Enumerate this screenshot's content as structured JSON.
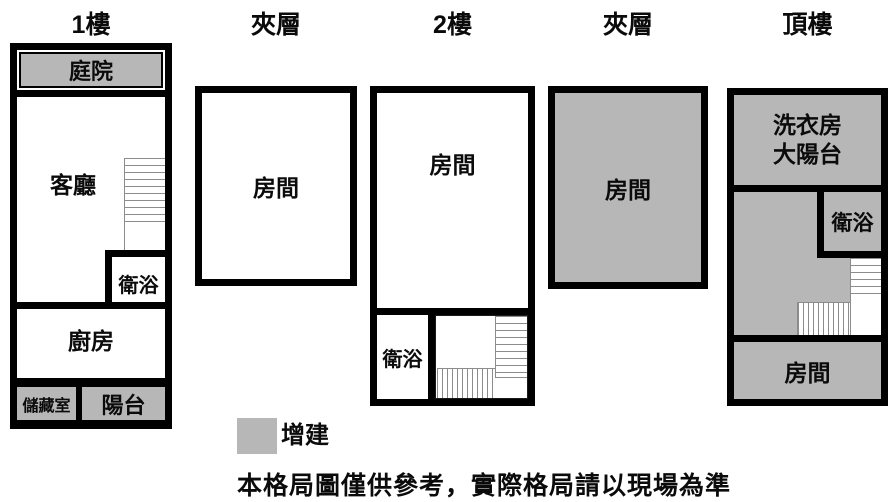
{
  "diagram": {
    "floors": [
      {
        "title": "1樓",
        "rooms": {
          "courtyard": "庭院",
          "living_room": "客廳",
          "bathroom": "衛浴",
          "kitchen": "廚房",
          "storage": "儲藏室",
          "balcony": "陽台"
        }
      },
      {
        "title": "夾層",
        "rooms": {
          "room": "房間"
        }
      },
      {
        "title": "2樓",
        "rooms": {
          "room": "房間",
          "bathroom": "衛浴"
        }
      },
      {
        "title": "夾層",
        "rooms": {
          "room": "房間"
        }
      },
      {
        "title": "頂樓",
        "rooms": {
          "laundry_line1": "洗衣房",
          "laundry_line2": "大陽台",
          "bathroom": "衛浴",
          "room": "房間"
        }
      }
    ],
    "legend": {
      "addition_label": "增建"
    },
    "disclaimer": "本格局圖僅供參考，實際格局請以現場為準"
  },
  "colors": {
    "addition_gray": "#b7b7b7",
    "wall": "#000000",
    "stair_line": "#8c8c8c"
  }
}
